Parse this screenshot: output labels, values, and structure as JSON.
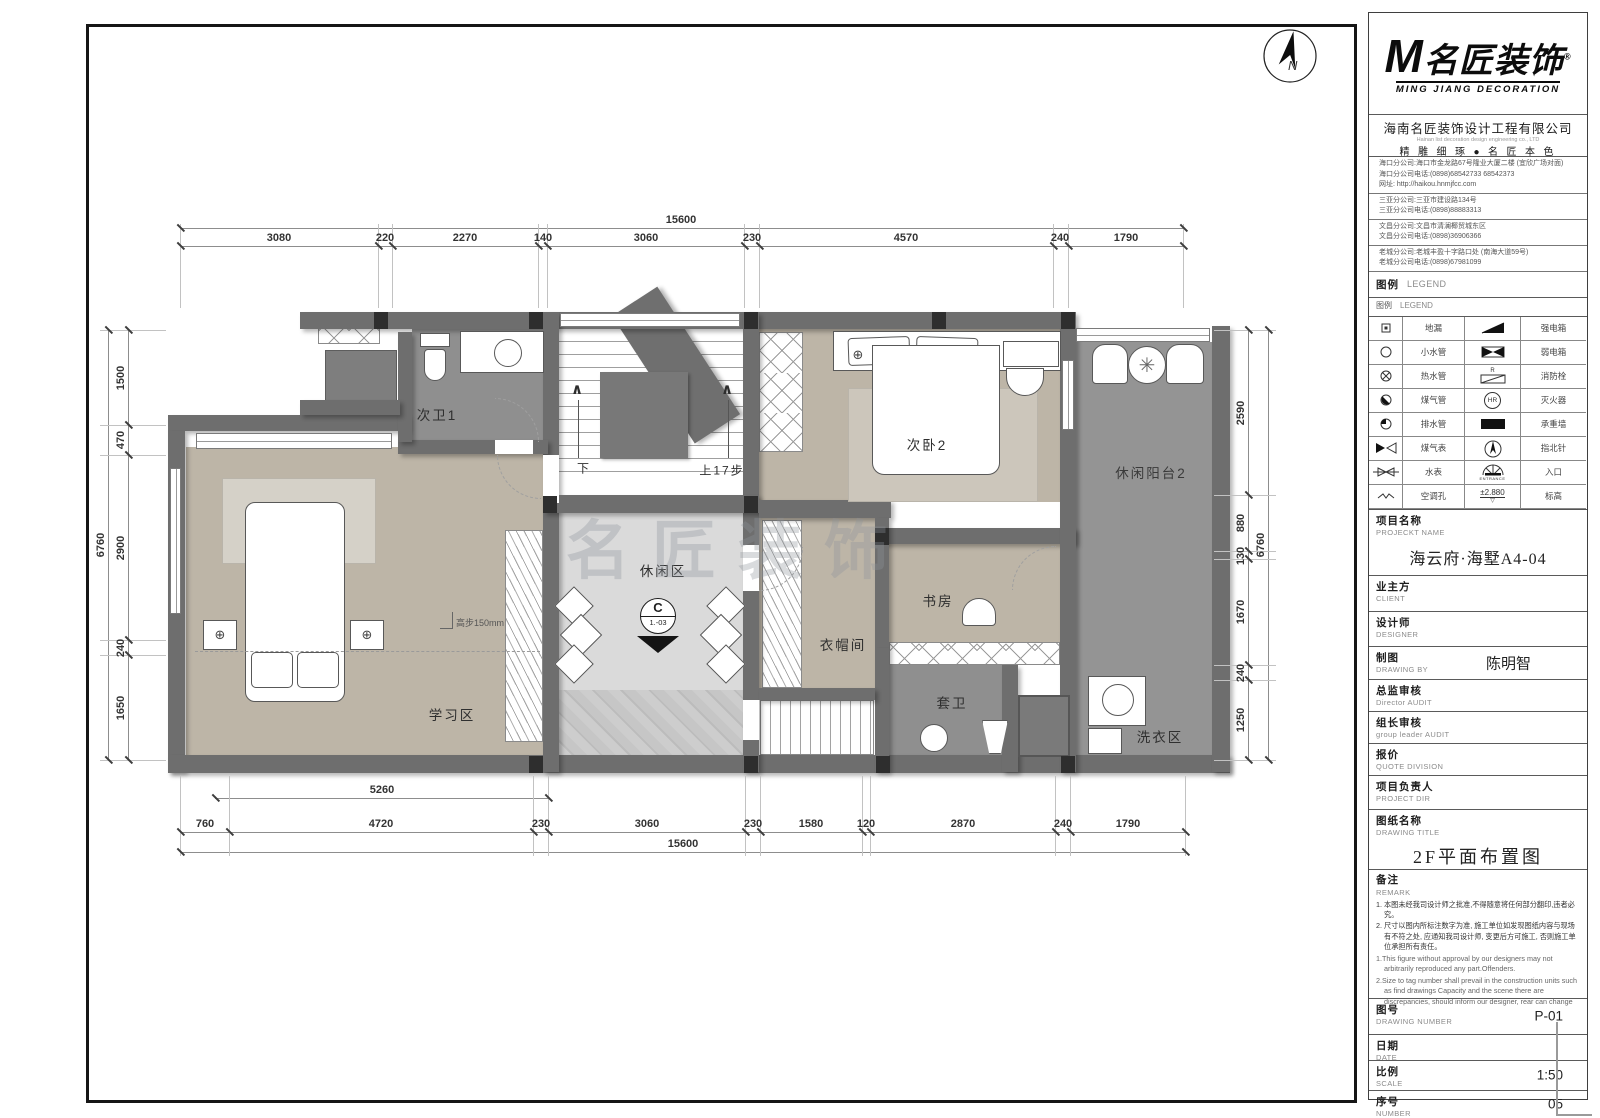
{
  "plan": {
    "watermark": "名匠装饰",
    "compass": "N",
    "rooms": {
      "bath2_1": "次卫1",
      "bedroom2": "次卧2",
      "balcony2": "休闲阳台2",
      "leisure": "休闲区",
      "study_area": "学习区",
      "cloakroom": "衣帽间",
      "study": "书房",
      "ensuite": "套卫",
      "laundry": "洗衣区"
    },
    "stairs": {
      "down": "下",
      "up": "上17步"
    },
    "section_marker": {
      "letter": "C",
      "code": "1.-03"
    },
    "step_note": "高步150mm",
    "dims": {
      "top_total": "15600",
      "top": [
        "3080",
        "220",
        "2270",
        "140",
        "3060",
        "230",
        "4570",
        "240",
        "1790"
      ],
      "bottom": [
        "760",
        "4720",
        "230",
        "3060",
        "230",
        "1580",
        "120",
        "2870",
        "240",
        "1790"
      ],
      "bottom_total": "15600",
      "bottom_inner": "5260",
      "left": [
        "1500",
        "470",
        "2900",
        "240",
        "1650"
      ],
      "left_total": "6760",
      "right": [
        "2590",
        "880",
        "130",
        "1670",
        "240",
        "1250"
      ],
      "right_total": "6760"
    }
  },
  "title_block": {
    "logo": {
      "m": "M",
      "brand": "名匠装饰",
      "reg": "®",
      "subtitle": "MING JIANG DECORATION"
    },
    "company": {
      "name_cn": "海南名匠装饰设计工程有限公司",
      "name_en": "Hainan list decoration design engineering co., LTD",
      "slogan": "精 雕 细 琢 ● 名 匠 本 色"
    },
    "branches": [
      {
        "lines": [
          "海口分公司:海口市金龙路67号隆业大厦二楼 (宜欣广场对面)",
          "海口分公司电话:(0898)68542733 68542373",
          "网址: http://haikou.hnmjfcc.com"
        ]
      },
      {
        "lines": [
          "三亚分公司:三亚市建设路134号",
          "三亚分公司电话:(0898)88883313"
        ]
      },
      {
        "lines": [
          "文昌分公司:文昌市清澜椰贸城东区",
          "文昌分公司电话:(0898)36906366"
        ]
      },
      {
        "lines": [
          "老城分公司:老城丰盈十字路口处 (南海大道59号)",
          "老城分公司电话:(0898)67981099"
        ]
      }
    ],
    "legend": {
      "header_cn": "图例",
      "header_en": "LEGEND",
      "sub_cn": "图例",
      "sub_en": "LEGEND",
      "rows": [
        {
          "l": "地漏",
          "r": "强电箱"
        },
        {
          "l": "小水管",
          "r": "弱电箱"
        },
        {
          "l": "热水管",
          "r": "消防栓"
        },
        {
          "l": "煤气管",
          "r": "灭火器"
        },
        {
          "l": "排水管",
          "r": "承重墙"
        },
        {
          "l": "煤气表",
          "r": "指北针"
        },
        {
          "l": "水表",
          "r": "入口"
        },
        {
          "l": "空调孔",
          "r": "标高"
        }
      ],
      "texts": {
        "hr": "HR",
        "r": "R",
        "entrance": "ENTRANCE",
        "level": "±2.880"
      }
    },
    "project_name": {
      "label_cn": "项目名称",
      "label_en": "PROJECKT NAME",
      "value": "海云府·海墅A4-04"
    },
    "client": {
      "label_cn": "业主方",
      "label_en": "CLIENT",
      "value": ""
    },
    "designer": {
      "label_cn": "设计师",
      "label_en": "DESIGNER",
      "value": ""
    },
    "drawing_by": {
      "label_cn": "制图",
      "label_en": "DRAWING BY",
      "value": "陈明智"
    },
    "director_audit": {
      "label_cn": "总监审核",
      "label_en": "Director AUDIT",
      "value": ""
    },
    "group_leader_audit": {
      "label_cn": "组长审核",
      "label_en": "group leader AUDIT",
      "value": ""
    },
    "quote": {
      "label_cn": "报价",
      "label_en": "QUOTE DIVISION",
      "value": ""
    },
    "project_dir": {
      "label_cn": "项目负责人",
      "label_en": "PROJECT DIR",
      "value": ""
    },
    "drawing_title": {
      "label_cn": "图纸名称",
      "label_en": "DRAWING TITLE",
      "value": "2F平面布置图"
    },
    "remark": {
      "label_cn": "备注",
      "label_en": "REMARK",
      "cn": [
        "1. 本图未经我司设计师之批准,不得随意将任何部分翻印,违者必究。",
        "2. 尺寸以图内所标注数字为准, 施工单位如发现图纸内容与现场有不符之处, 应通知我司设计师, 变更后方可施工, 否则施工单位承担所有责任。"
      ],
      "en": [
        "1.This figure without approval by our designers may not arbitrarily reproduced any part.Offenders.",
        "2.Size to tag number shall prevail in the construction units such as find drawings Capacity and the scene there are discrepancies, should inform our designer, rear can change"
      ]
    },
    "drawing_number": {
      "label_cn": "图号",
      "label_en": "DRAWING NUMBER",
      "value": "P-01"
    },
    "date": {
      "label_cn": "日期",
      "label_en": "DATE",
      "value": ""
    },
    "scale": {
      "label_cn": "比例",
      "label_en": "SCALE",
      "value": "1:50"
    },
    "number": {
      "label_cn": "序号",
      "label_en": "NUMBER",
      "value": "05"
    }
  }
}
